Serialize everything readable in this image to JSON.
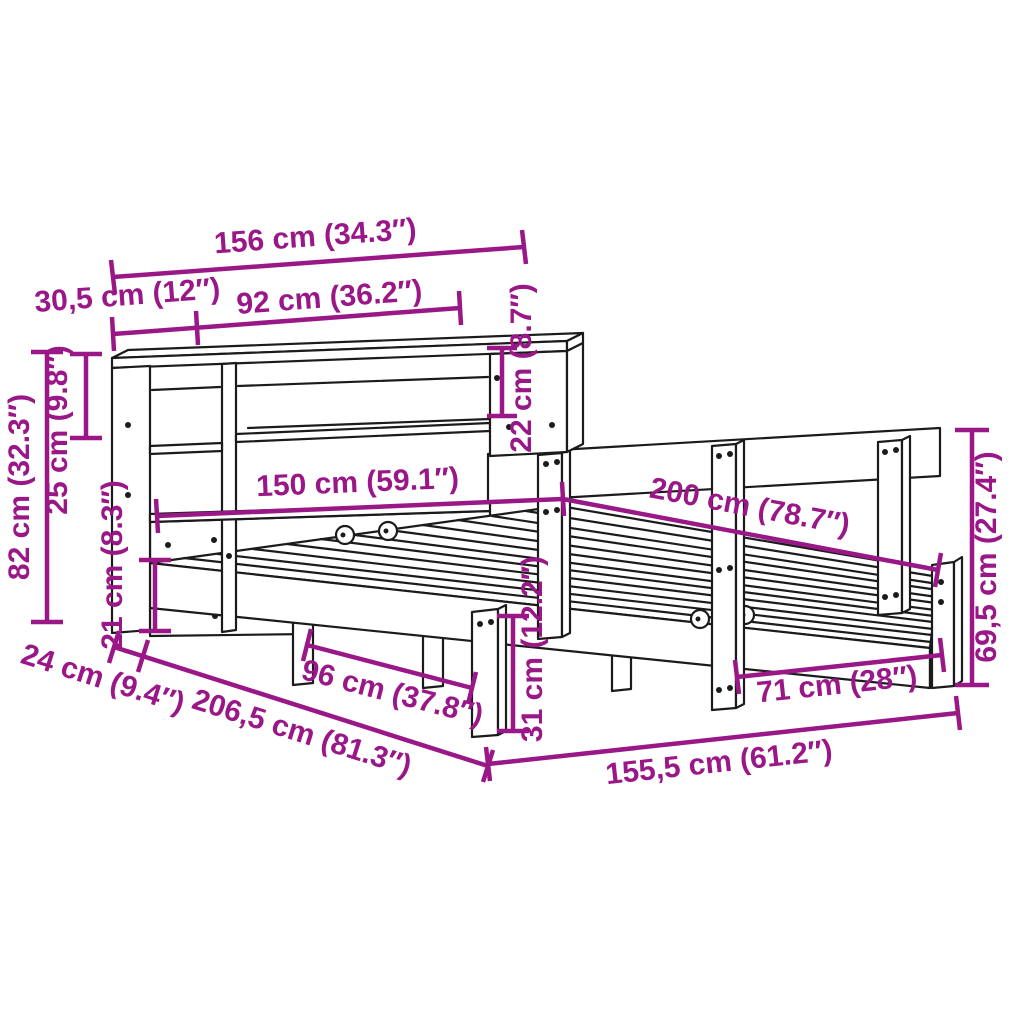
{
  "diagram": {
    "kind": "furniture dimension drawing",
    "subject": "bed frame with bookshelf headboard"
  },
  "colors": {
    "annotation": "#9a1787",
    "linework": "#1b1b1b",
    "background": "#ffffff"
  },
  "labels": {
    "d156": "156 cm (34.3″)",
    "d30_5": "30,5 cm (12″)",
    "d92": "92 cm (36.2″)",
    "d22": "22 cm (8.7″)",
    "d82": "82 cm (32.3″)",
    "d25": "25 cm (9.8″)",
    "d21": "21 cm (8.3″)",
    "d150": "150 cm (59.1″)",
    "d200": "200 cm (78.7″)",
    "d69_5": "69,5 cm (27.4″)",
    "d71": "71 cm (28″)",
    "d155_5": "155,5 cm (61.2″)",
    "d31": "31 cm (12.2″)",
    "d96": "96 cm (37.8″)",
    "d24": "24 cm (9.4″)",
    "d206_5": "206,5 cm (81.3″)"
  }
}
